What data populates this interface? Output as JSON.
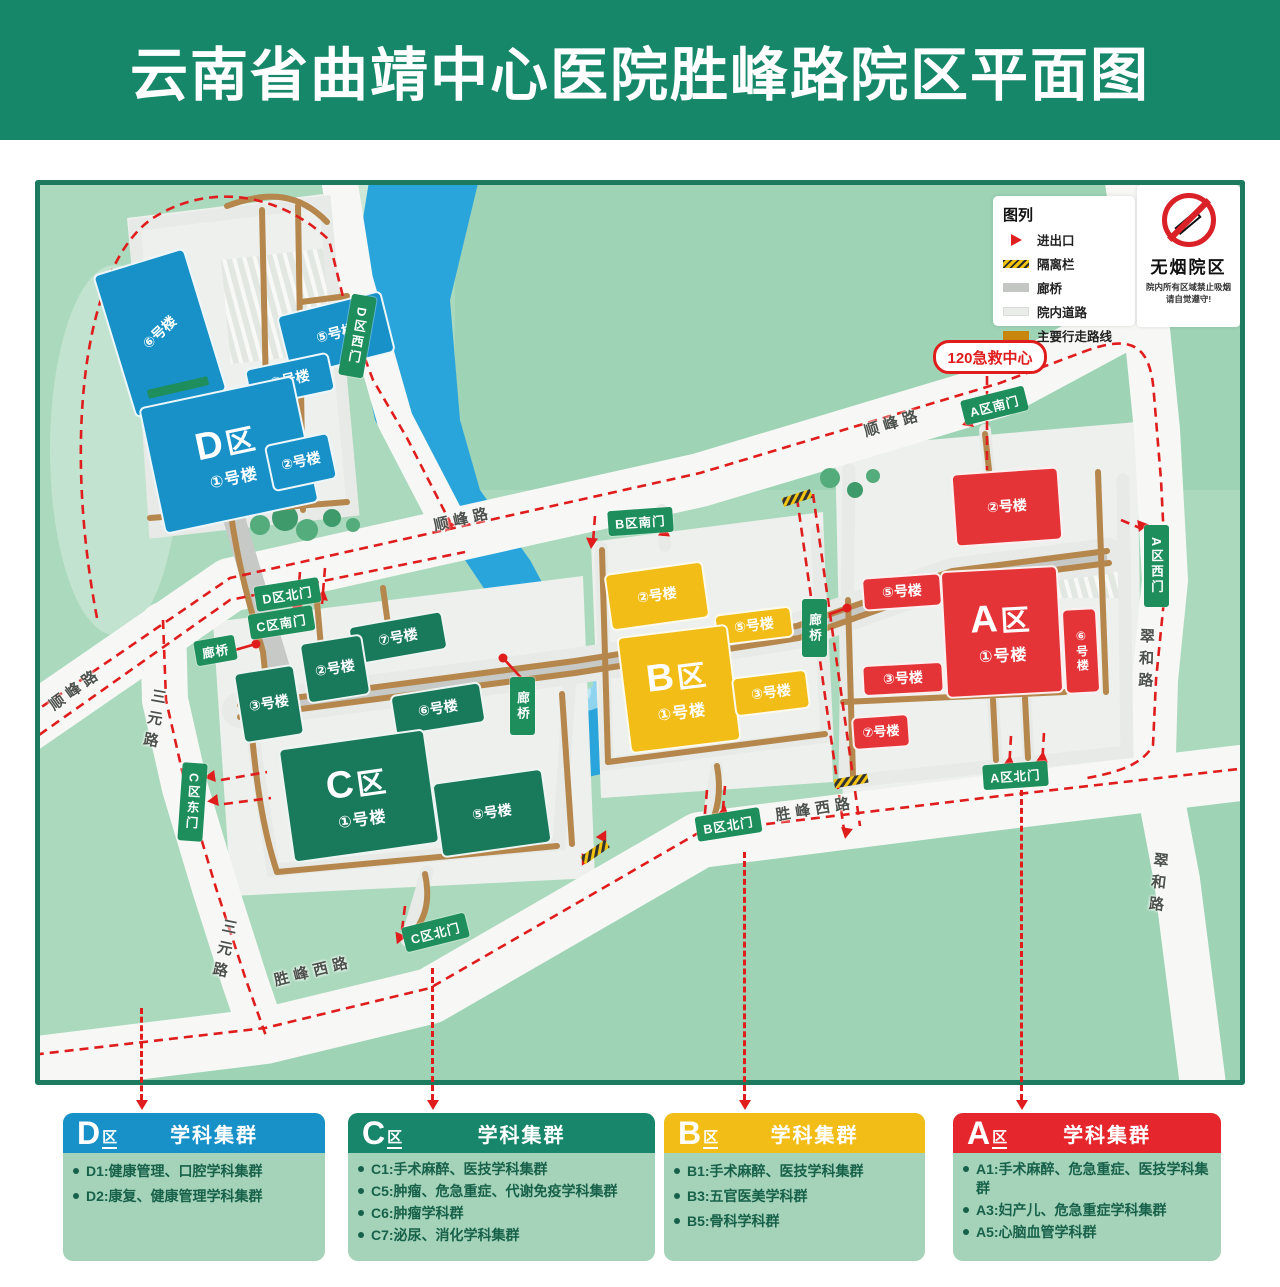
{
  "title": "云南省曲靖中心医院胜峰路院区平面图",
  "legend": {
    "title": "图列",
    "items": [
      {
        "icon": "entrance-arrow",
        "label": "进出口"
      },
      {
        "icon": "isolation-fence",
        "label": "隔离栏"
      },
      {
        "icon": "corridor-bridge",
        "label": "廊桥"
      },
      {
        "icon": "campus-road",
        "label": "院内道路"
      },
      {
        "icon": "main-walking-route",
        "label": "主要行走路线"
      }
    ]
  },
  "no_smoking": {
    "title": "无烟院区",
    "line1": "院内所有区域禁止吸烟",
    "line2": "请自觉遵守!"
  },
  "emergency": {
    "label": "120急救中心"
  },
  "colors": {
    "zone_a": "#e43438",
    "zone_b": "#f2bd17",
    "zone_c": "#19795b",
    "zone_d": "#1791c8",
    "gate_sign": "#1e8e5c",
    "walking_route": "#b5874d",
    "dashed_route": "#e01d1d",
    "river": "#2aa5dc"
  },
  "gates": {
    "d_west": "D区西门",
    "d_north": "D区北门",
    "c_south": "C区南门",
    "c_east": "C区东门",
    "c_north": "C区北门",
    "b_south": "B区南门",
    "b_north": "B区北门",
    "a_south": "A区南门",
    "a_north": "A区北门",
    "a_west": "A区西门",
    "bridge": "廊桥"
  },
  "roads": {
    "shunfeng": "顺峰路",
    "sanyuan": "三元路",
    "shengfengxi": "胜峰西路",
    "cuihe": "翠和路"
  },
  "zones": {
    "d": {
      "letter": "D",
      "suffix": "区",
      "main": "①号楼",
      "b2": "②号楼",
      "b3": "③号楼",
      "b5": "⑤号楼",
      "b6": "⑥号楼"
    },
    "c": {
      "letter": "C",
      "suffix": "区",
      "main": "①号楼",
      "b2": "②号楼",
      "b3": "③号楼",
      "b5": "⑤号楼",
      "b6": "⑥号楼",
      "b7": "⑦号楼"
    },
    "b": {
      "letter": "B",
      "suffix": "区",
      "main": "①号楼",
      "b2": "②号楼",
      "b3": "③号楼",
      "b5": "⑤号楼"
    },
    "a": {
      "letter": "A",
      "suffix": "区",
      "main": "①号楼",
      "b2": "②号楼",
      "b3": "③号楼",
      "b5": "⑤号楼",
      "b6": "⑥号楼",
      "b7": "⑦号楼"
    }
  },
  "cards": [
    {
      "letter": "D",
      "suffix": "区",
      "header": "学科集群",
      "items": [
        "D1:健康管理、口腔学科集群",
        "D2:康复、健康管理学科集群"
      ]
    },
    {
      "letter": "C",
      "suffix": "区",
      "header": "学科集群",
      "items": [
        "C1:手术麻醉、医技学科集群",
        "C5:肿瘤、危急重症、代谢免疫学科集群",
        "C6:肿瘤学科群",
        "C7:泌尿、消化学科集群"
      ]
    },
    {
      "letter": "B",
      "suffix": "区",
      "header": "学科集群",
      "items": [
        "B1:手术麻醉、医技学科集群",
        "B3:五官医美学科群",
        "B5:骨科学科群"
      ]
    },
    {
      "letter": "A",
      "suffix": "区",
      "header": "学科集群",
      "items": [
        "A1:手术麻醉、危急重症、医技学科集群",
        "A3:妇产儿、危急重症学科集群",
        "A5:心脑血管学科群"
      ]
    }
  ]
}
